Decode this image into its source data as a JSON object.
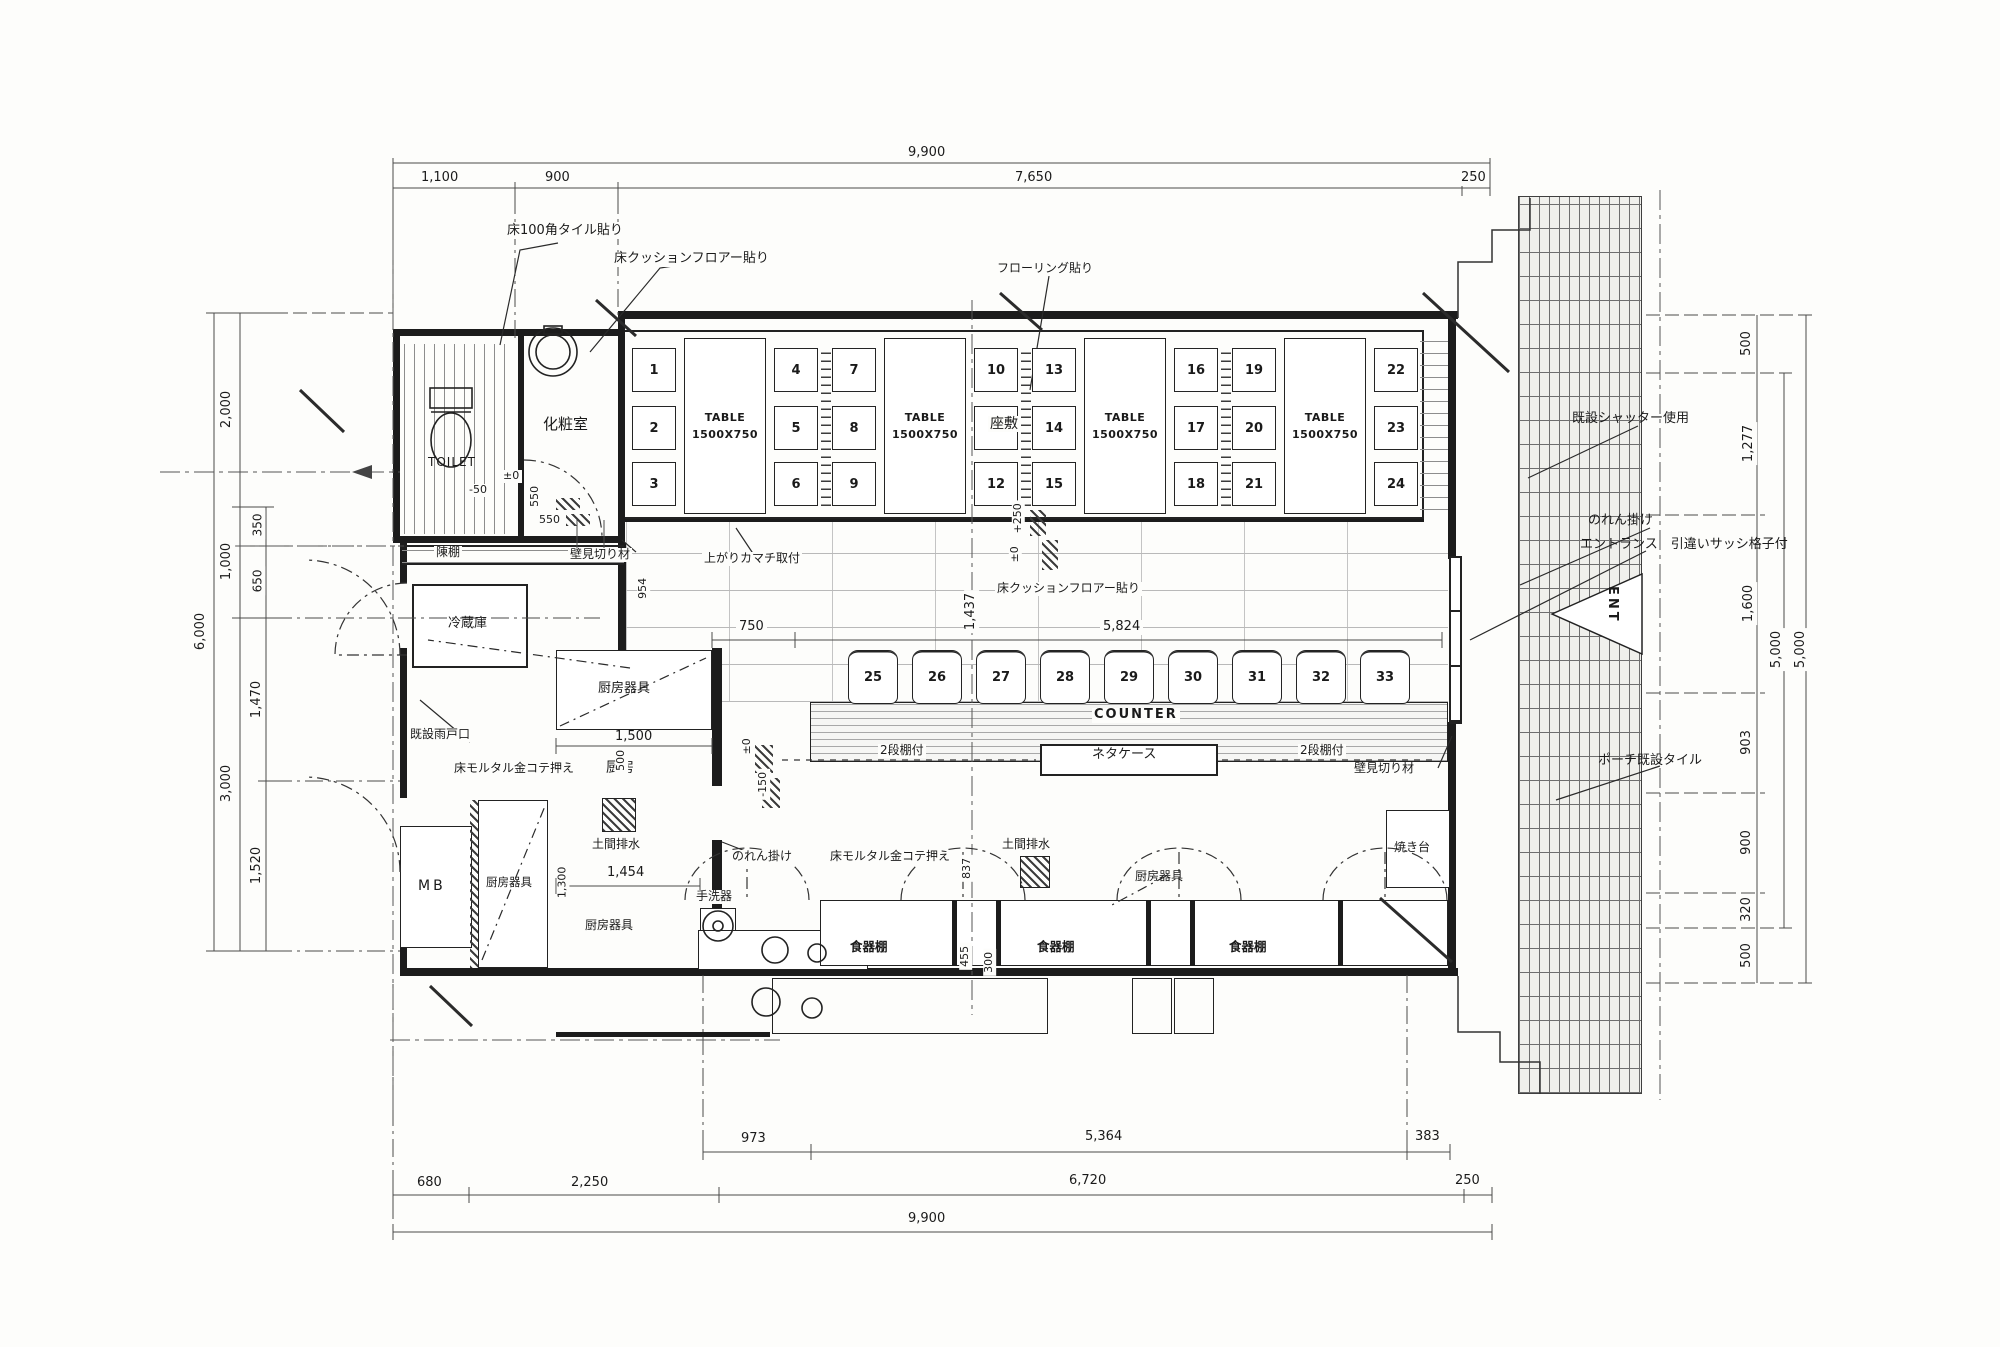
{
  "dims": {
    "top": {
      "overall": "9,900",
      "s1": "1,100",
      "s2": "900",
      "s3": "7,650",
      "s4": "250"
    },
    "bottom": {
      "r1a": "973",
      "r1b": "5,364",
      "r1c": "383",
      "r2a": "680",
      "r2b": "2,250",
      "r2c": "6,720",
      "r2d": "250",
      "overall": "9,900"
    },
    "left": {
      "overall": "6,000",
      "a": "2,000",
      "b": "1,000",
      "c": "3,000",
      "d": "350",
      "e": "650",
      "f": "1,470",
      "g": "1,520"
    },
    "right": {
      "outer": "5,000",
      "inner": "5,000",
      "a": "500",
      "b": "1,277",
      "c": "1,600",
      "d": "903",
      "e": "900",
      "f": "320",
      "g": "500"
    },
    "plan": {
      "m50": "-50",
      "pm0": "±0",
      "v550": "550",
      "h550": "550",
      "v954": "954",
      "h750": "750",
      "v1437": "1,437",
      "h5824": "5,824",
      "p250": "+250",
      "pm0b": "±0",
      "h1500": "1,500",
      "pm0c": "±0",
      "m150": "-150",
      "v500": "500",
      "v1300": "1,300",
      "h1454": "1,454",
      "v837": "837",
      "v455": "455",
      "v300": "300"
    }
  },
  "rooms": {
    "toilet": "TOILET",
    "powder": "化粧室",
    "fridge": "冷蔵庫",
    "mb": "MB",
    "kitchen": "厨房",
    "zashiki": "座敷",
    "counter": "COUNTER",
    "neta_case": "ネタケース",
    "yakidai": "焼き台",
    "shokkidana": "食器棚",
    "tearai": "手洗器",
    "doma_drain": "土間排水",
    "tana": "陳棚",
    "ent": "ENT"
  },
  "equip": {
    "kigu": "厨房器具",
    "nidana": "2段棚付"
  },
  "table": {
    "l1": "TABLE",
    "l2": "1500X750"
  },
  "ann": {
    "tile100": "床100角タイル貼り",
    "cushion": "床クッションフロアー貼り",
    "flooring": "フローリング貼り",
    "mikiri": "壁見切り材",
    "kamachi": "上がりカマチ取付",
    "shutter": "既設シャッター使用",
    "noren": "のれん掛け",
    "entrance": "エントランス　引違いサッシ格子付",
    "porch": "ポーチ既設タイル",
    "amado": "既設雨戸口",
    "mortar": "床モルタル金コテ押え"
  },
  "seats": [
    "1",
    "2",
    "3",
    "4",
    "5",
    "6",
    "7",
    "8",
    "9",
    "10",
    "11",
    "12",
    "13",
    "14",
    "15",
    "16",
    "17",
    "18",
    "19",
    "20",
    "21",
    "22",
    "23",
    "24"
  ],
  "stools": [
    "25",
    "26",
    "27",
    "28",
    "29",
    "30",
    "31",
    "32",
    "33"
  ]
}
